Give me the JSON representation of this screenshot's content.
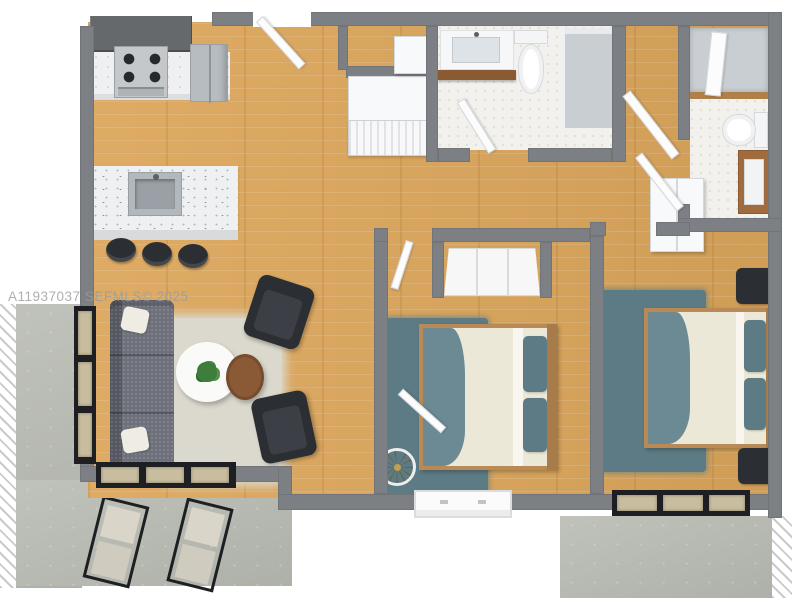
{
  "watermark": {
    "text": "A11937037  SEFMLS© 2025"
  },
  "colors": {
    "wall": "#7c7f83",
    "wood": "#dda75c",
    "tile": "#f3f1ed",
    "concrete": "#b9bcb3",
    "teal": "#5d7b84",
    "ruglight": "#dbd8cd",
    "sofa": "#6e717c",
    "dark": "#2b2e32",
    "metal": "#c4c8cb",
    "counterwhite": "#eef0f1",
    "darkcabinet": "#66696c",
    "fridge": "#b7bcc0",
    "glasstan": "#c8bd9e",
    "framedark": "#1d1f22",
    "doorwhite": "#fcfcfd",
    "shower": "#c9ced2",
    "trimwood": "#b08049",
    "vanitywood": "#a06b3f",
    "blanket": "#6b8a94",
    "sheet": "#ece8d8",
    "bedwood": "#b98a55",
    "plantgreen": "#3f7d3c",
    "tablebrown": "#8a5a36",
    "cushion": "#d9d5c8",
    "watermark": "#9b9b9b"
  },
  "floorplan": {
    "view": "3d-top-down-render",
    "rooms": [
      {
        "name": "kitchen",
        "features": [
          "upper-cabinets",
          "gas-range",
          "refrigerator",
          "island-with-sink",
          "three-bar-stools"
        ]
      },
      {
        "name": "living-room",
        "features": [
          "gray-sofa",
          "two-accent-chairs",
          "round-coffee-table",
          "round-side-table",
          "area-rug",
          "potted-plant"
        ]
      },
      {
        "name": "entry-hall",
        "features": [
          "entry-door",
          "louvered-closet",
          "linen-closet"
        ]
      },
      {
        "name": "bathroom-1",
        "features": [
          "vanity-sink",
          "wood-shelf",
          "toilet",
          "walk-in-shower"
        ]
      },
      {
        "name": "bathroom-2",
        "features": [
          "shower",
          "toilet",
          "wood-vanity-sink"
        ]
      },
      {
        "name": "bedroom-1",
        "features": [
          "double-bed",
          "teal-area-rug",
          "sliding-door-closet",
          "floor-fan",
          "window"
        ]
      },
      {
        "name": "bedroom-2",
        "features": [
          "double-bed",
          "two-nightstands",
          "teal-area-rug",
          "closet",
          "sliding-glass-door"
        ]
      },
      {
        "name": "patio-left",
        "features": [
          "concrete-slab",
          "two-lounge-chairs",
          "black-framed-windows",
          "sliding-glass-door"
        ]
      },
      {
        "name": "patio-right",
        "features": [
          "concrete-slab"
        ]
      }
    ]
  }
}
